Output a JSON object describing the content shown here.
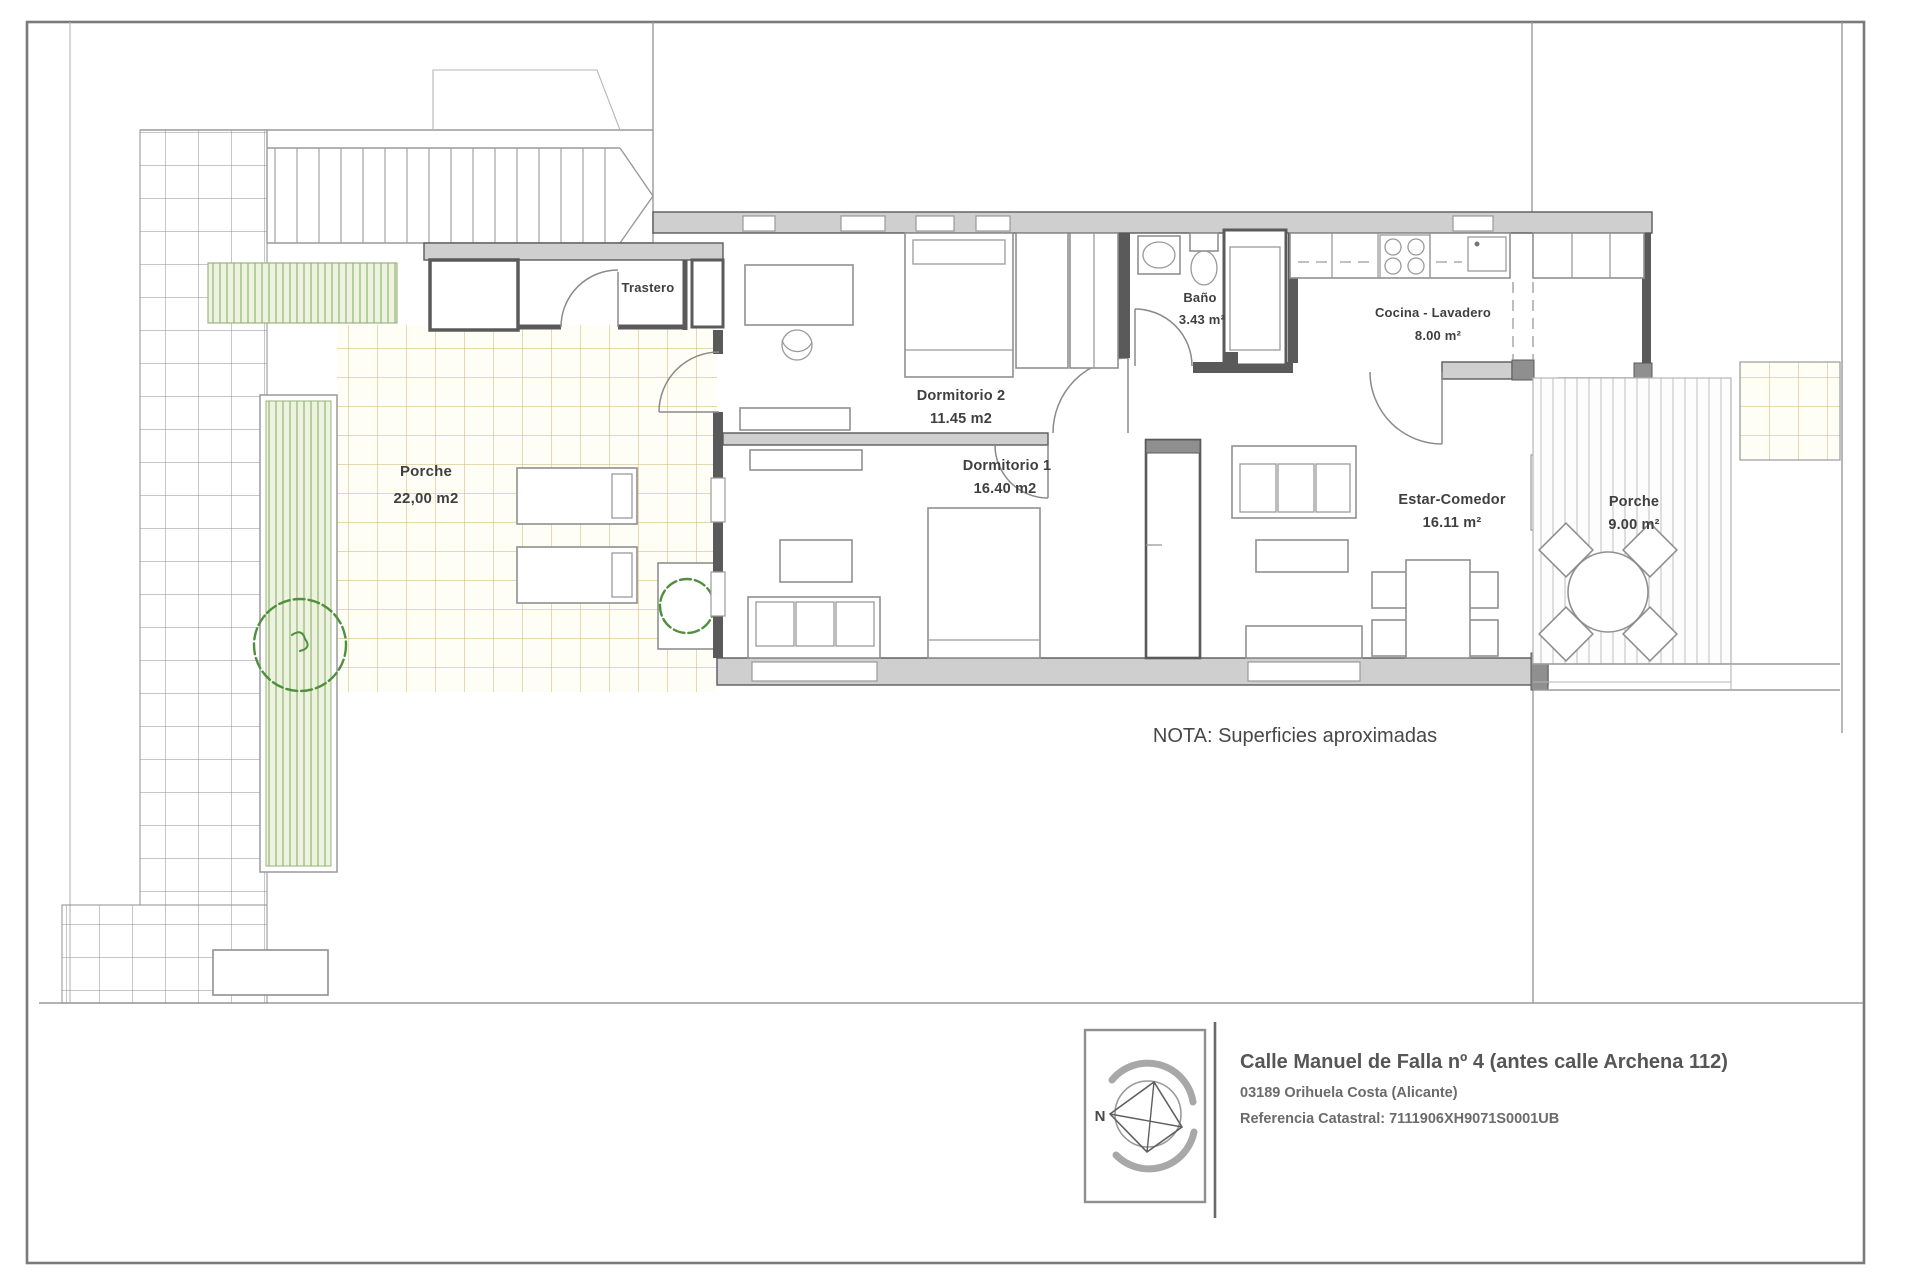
{
  "sheet": {
    "note": "NOTA: Superficies aproximadas",
    "compass": {
      "north": "N"
    },
    "title_block": {
      "line1": "Calle Manuel de Falla nº 4 (antes calle Archena 112)",
      "line2": "03189 Orihuela Costa (Alicante)",
      "line3": "Referencia Catastral: 7111906XH9071S0001UB"
    }
  },
  "rooms": {
    "trastero": {
      "name": "Trastero"
    },
    "porche_oeste": {
      "name": "Porche",
      "area": "22,00 m2"
    },
    "dormitorio2": {
      "name": "Dormitorio 2",
      "area": "11.45 m2"
    },
    "dormitorio1": {
      "name": "Dormitorio 1",
      "area": "16.40 m2"
    },
    "bano": {
      "name": "Baño",
      "area": "3.43 m²"
    },
    "cocina": {
      "name": "Cocina - Lavadero",
      "area": "8.00 m²"
    },
    "estar": {
      "name": "Estar-Comedor",
      "area": "16.11 m²"
    },
    "porche_este": {
      "name": "Porche",
      "area": "9.00 m²"
    }
  },
  "colors": {
    "wall_fill": "#cfcfcf",
    "wall_line": "#5a5a5a",
    "tile_line": "#c9b468",
    "hedge_green": "#a9c491",
    "tree_green": "#4f8f3e",
    "ink": "#3f3f3f"
  }
}
